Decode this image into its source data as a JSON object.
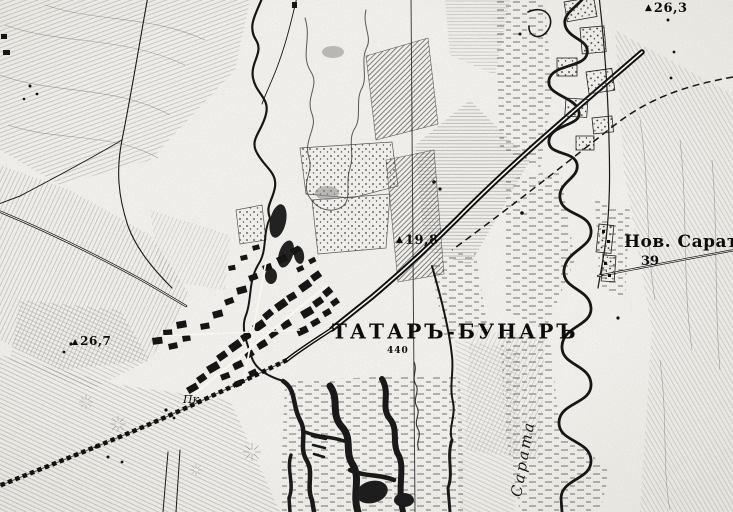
{
  "map": {
    "colors": {
      "paper": "#f7f6f1",
      "ink": "#141414",
      "hachure": "#6e6e6e"
    },
    "triangulation_icon": "▲",
    "town": {
      "name": "ТАТАРЪ-БУНАРЪ",
      "number": "440"
    },
    "village": {
      "name": "Нов. Сарат",
      "number": "39"
    },
    "river": {
      "name": "Сарата"
    },
    "site_abbrev": "Пк.",
    "elevations": [
      {
        "value": "26,3"
      },
      {
        "value": "26,7"
      },
      {
        "value": "19,8"
      }
    ]
  }
}
